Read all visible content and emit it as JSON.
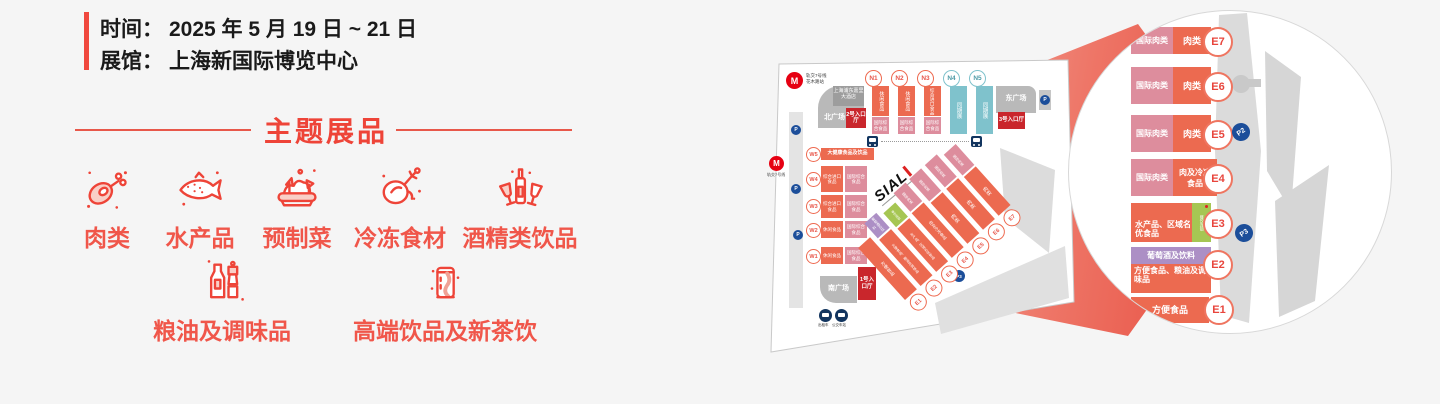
{
  "info": {
    "time_label": "时间：",
    "time_value": "2025 年 5 月 19 日 ~ 21 日",
    "venue_label": "展馆：",
    "venue_value": "上海新国际博览中心"
  },
  "section": {
    "title": "主题展品"
  },
  "categories": [
    {
      "name": "肉类"
    },
    {
      "name": "水产品"
    },
    {
      "name": "预制菜"
    },
    {
      "name": "冷冻食材"
    },
    {
      "name": "酒精类饮品"
    },
    {
      "name": "粮油及调味品"
    },
    {
      "name": "高端饮品及新茶饮"
    }
  ],
  "map": {
    "logo": "SIAL",
    "metro_top_line1": "轨交7号线",
    "metro_top_line2": "花木路站",
    "metro_left": "轨交7号线",
    "metro_m": "M",
    "hotel": "上海浦东嘉里大酒店",
    "north_square": "北广场",
    "east_square": "东广场",
    "south_square": "南广场",
    "entrance1": "1号入口厅",
    "entrance2": "2号入口厅",
    "entrance3": "3号入口厅",
    "n_halls": [
      {
        "id": "N1",
        "label": "休闲食品",
        "sub": "国际综合食品"
      },
      {
        "id": "N2",
        "label": "休闲食品",
        "sub": "国际综合食品"
      },
      {
        "id": "N3",
        "label": "综合进口食品",
        "sub": "国际综合食品"
      },
      {
        "id": "N4",
        "label": "同期展"
      },
      {
        "id": "N5",
        "label": "同期展"
      }
    ],
    "w_halls": [
      {
        "id": "W5",
        "label": "大健康食品及饮品"
      },
      {
        "id": "W4",
        "label": "综合进口食品",
        "sub": "国际综合食品"
      },
      {
        "id": "W3",
        "label": "综合进口食品",
        "sub": "国际综合食品"
      },
      {
        "id": "W2",
        "label": "休闲食品",
        "sub": "国际综合食品"
      },
      {
        "id": "W1",
        "label": "休闲食品",
        "sub": "国际综合食品"
      }
    ],
    "e_halls": [
      {
        "id": "E1",
        "label": "方便食品"
      },
      {
        "id": "E2",
        "label": "方便食品、粮油及调味品",
        "top": "葡萄酒及饮料"
      },
      {
        "id": "E3",
        "label": "水产品、区域名优食品",
        "extra": "餐饮连锁"
      },
      {
        "id": "E4",
        "label": "肉及冷冻食品",
        "top": "国际肉类"
      },
      {
        "id": "E5",
        "label": "肉类",
        "top": "国际肉类"
      },
      {
        "id": "E6",
        "label": "肉类",
        "top": "国际肉类"
      },
      {
        "id": "E7",
        "label": "肉类",
        "top": "国际肉类"
      }
    ],
    "parking": "P",
    "p2": "P2",
    "p3": "P3",
    "taxi": "出租车",
    "bus": "公交车站"
  },
  "magnifier": {
    "rows": [
      {
        "id": "E7",
        "left": "国际肉类",
        "main": "肉类"
      },
      {
        "id": "E6",
        "left": "国际肉类",
        "main": "肉类"
      },
      {
        "id": "E5",
        "left": "国际肉类",
        "main": "肉类"
      },
      {
        "id": "E4",
        "left": "国际肉类",
        "main": "肉及冷冻食品"
      },
      {
        "id": "E3",
        "main": "水产品、区域名优食品",
        "extra": "餐饮连锁"
      },
      {
        "id": "E2",
        "top": "葡萄酒及饮料",
        "main": "方便食品、粮油及调味品"
      },
      {
        "id": "E1",
        "main": "方便食品"
      }
    ],
    "p2": "P2",
    "p3": "P3"
  },
  "colors": {
    "accent_red": "#f0483e",
    "title_red": "#ee4438",
    "hall_orange": "#ec6a50",
    "hall_pink": "#dd8d9d",
    "hall_teal": "#7fc2cc",
    "entrance_red": "#c9262c",
    "hall_green": "#a6c653",
    "hall_purple": "#ac8fc5",
    "parking_navy": "#1c4e9a",
    "metro_red": "#e60012"
  }
}
